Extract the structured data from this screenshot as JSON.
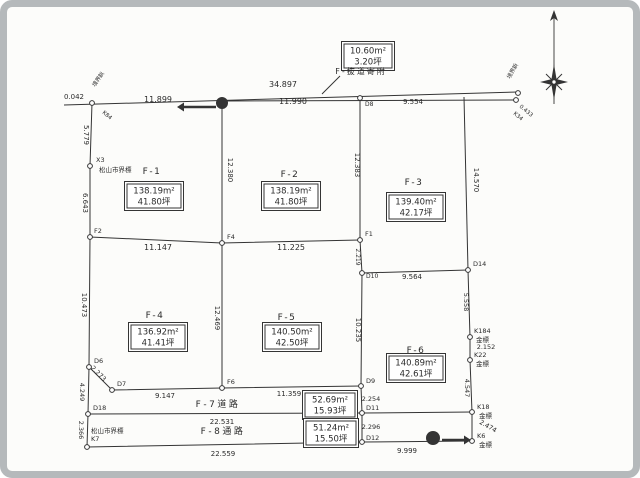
{
  "document": {
    "kind": "scanned land subdivision survey plan"
  },
  "palette": {
    "ink": "#343434",
    "paper": "#fcfcfa",
    "frame": "#b5b9bb",
    "box_bg": "#ffffff"
  },
  "annotation_box": {
    "area": "10.60m²",
    "tsubo": "3.20坪",
    "caption": "F-抜道寄附",
    "box_x": 368,
    "box_y": 56,
    "caption_x": 361,
    "caption_y": 74
  },
  "plots": [
    {
      "id": "F-1",
      "area": "138.19m²",
      "tsubo": "41.80坪",
      "label_x": 152,
      "label_y": 174,
      "box_x": 154,
      "box_y": 196
    },
    {
      "id": "F-2",
      "area": "138.19m²",
      "tsubo": "41.80坪",
      "label_x": 290,
      "label_y": 177,
      "box_x": 291,
      "box_y": 196
    },
    {
      "id": "F-3",
      "area": "139.40m²",
      "tsubo": "42.17坪",
      "label_x": 414,
      "label_y": 185,
      "box_x": 416,
      "box_y": 207
    },
    {
      "id": "F-4",
      "area": "136.92m²",
      "tsubo": "41.41坪",
      "label_x": 155,
      "label_y": 318,
      "box_x": 158,
      "box_y": 337
    },
    {
      "id": "F-5",
      "area": "140.50m²",
      "tsubo": "42.50坪",
      "label_x": 287,
      "label_y": 320,
      "box_x": 292,
      "box_y": 337
    },
    {
      "id": "F-6",
      "area": "140.89m²",
      "tsubo": "42.61坪",
      "label_x": 416,
      "label_y": 353,
      "box_x": 416,
      "box_y": 368
    }
  ],
  "roads": [
    {
      "id": "F-7道路",
      "area": "52.69m²",
      "tsubo": "15.93坪",
      "label_x": 218,
      "label_y": 407,
      "box_x": 330,
      "box_y": 405
    },
    {
      "id": "F-8通路",
      "area": "51.24m²",
      "tsubo": "15.50坪",
      "label_x": 223,
      "label_y": 434,
      "box_x": 331,
      "box_y": 433
    }
  ],
  "drawing": {
    "lines": [
      {
        "name": "top-road-line",
        "pts": [
          [
            64,
            105
          ],
          [
            518,
            92
          ]
        ]
      },
      {
        "name": "road-sliver-line",
        "pts": [
          [
            222,
            101
          ],
          [
            516,
            100
          ]
        ]
      },
      {
        "name": "left-boundary",
        "pts": [
          [
            92,
            103
          ],
          [
            90,
            166
          ],
          [
            90,
            237
          ],
          [
            89,
            367
          ],
          [
            88,
            414
          ],
          [
            87,
            447
          ]
        ]
      },
      {
        "name": "right-upper-boundary",
        "pts": [
          [
            464,
            97
          ],
          [
            468,
            270
          ]
        ]
      },
      {
        "name": "right-lower-boundary",
        "pts": [
          [
            468,
            270
          ],
          [
            470,
            337
          ],
          [
            470,
            360
          ],
          [
            472,
            412
          ],
          [
            472,
            441
          ]
        ]
      },
      {
        "name": "mid-horizontal-line",
        "pts": [
          [
            90,
            237
          ],
          [
            222,
            243
          ],
          [
            360,
            240
          ]
        ]
      },
      {
        "name": "f3-bottom-line",
        "pts": [
          [
            362,
            273
          ],
          [
            468,
            270
          ]
        ]
      },
      {
        "name": "divider-west",
        "pts": [
          [
            222,
            100
          ],
          [
            222,
            243
          ],
          [
            222,
            388
          ]
        ]
      },
      {
        "name": "divider-east",
        "pts": [
          [
            360,
            97
          ],
          [
            360,
            240
          ],
          [
            362,
            273
          ],
          [
            361,
            386
          ],
          [
            362,
            413
          ],
          [
            362,
            442
          ]
        ]
      },
      {
        "name": "road-top-line",
        "pts": [
          [
            112,
            390
          ],
          [
            222,
            388
          ],
          [
            361,
            386
          ]
        ]
      },
      {
        "name": "corner-diagonal",
        "pts": [
          [
            89,
            367
          ],
          [
            112,
            390
          ]
        ]
      },
      {
        "name": "road-mid-line",
        "pts": [
          [
            88,
            414
          ],
          [
            362,
            413
          ],
          [
            472,
            412
          ]
        ]
      },
      {
        "name": "bottom-line",
        "pts": [
          [
            87,
            447
          ],
          [
            362,
            442
          ],
          [
            472,
            441
          ]
        ]
      },
      {
        "name": "annotation-leader",
        "pts": [
          [
            340,
            76
          ],
          [
            322,
            94
          ]
        ]
      }
    ],
    "points": [
      [
        92,
        103
      ],
      [
        90,
        166
      ],
      [
        90,
        237
      ],
      [
        89,
        367
      ],
      [
        112,
        390
      ],
      [
        88,
        414
      ],
      [
        87,
        447
      ],
      [
        360,
        98
      ],
      [
        222,
        243
      ],
      [
        360,
        240
      ],
      [
        362,
        273
      ],
      [
        222,
        388
      ],
      [
        361,
        386
      ],
      [
        362,
        413
      ],
      [
        362,
        442
      ],
      [
        468,
        270
      ],
      [
        470,
        337
      ],
      [
        470,
        360
      ],
      [
        472,
        412
      ],
      [
        472,
        441
      ],
      [
        518,
        93
      ],
      [
        516,
        100
      ]
    ],
    "labels": [
      {
        "k": "measure",
        "t": "0.042",
        "x": 74,
        "y": 99,
        "s": 7
      },
      {
        "k": "measure",
        "t": "34.897",
        "x": 283,
        "y": 87,
        "s": 8
      },
      {
        "k": "measure",
        "t": "11.899",
        "x": 158,
        "y": 102,
        "s": 8
      },
      {
        "k": "measure",
        "t": "11.990",
        "x": 293,
        "y": 104,
        "s": 8
      },
      {
        "k": "measure",
        "t": "9.554",
        "x": 413,
        "y": 104,
        "s": 7
      },
      {
        "k": "measure",
        "t": "5.779",
        "x": 84,
        "y": 135,
        "s": 7,
        "r": 90
      },
      {
        "k": "measure",
        "t": "6.643",
        "x": 83,
        "y": 203,
        "s": 7,
        "r": 90
      },
      {
        "k": "measure",
        "t": "10.473",
        "x": 82,
        "y": 305,
        "s": 7,
        "r": 90
      },
      {
        "k": "measure",
        "t": "2.273",
        "x": 97,
        "y": 375,
        "s": 6.5,
        "r": 45
      },
      {
        "k": "measure",
        "t": "4.249",
        "x": 80,
        "y": 392,
        "s": 6.5,
        "r": 90
      },
      {
        "k": "measure",
        "t": "2.366",
        "x": 79,
        "y": 430,
        "s": 6.5,
        "r": 90
      },
      {
        "k": "measure",
        "t": "12.380",
        "x": 228,
        "y": 170,
        "s": 7,
        "r": 90
      },
      {
        "k": "measure",
        "t": "12.469",
        "x": 215,
        "y": 318,
        "s": 7,
        "r": 90
      },
      {
        "k": "measure",
        "t": "12.383",
        "x": 355,
        "y": 165,
        "s": 7,
        "r": 90
      },
      {
        "k": "measure",
        "t": "2.219",
        "x": 356,
        "y": 257,
        "s": 6,
        "r": 90
      },
      {
        "k": "measure",
        "t": "10.235",
        "x": 356,
        "y": 330,
        "s": 7,
        "r": 90
      },
      {
        "k": "measure",
        "t": "14.570",
        "x": 474,
        "y": 180,
        "s": 7,
        "r": 90
      },
      {
        "k": "measure",
        "t": "5.558",
        "x": 464,
        "y": 302,
        "s": 6.5,
        "r": 90
      },
      {
        "k": "measure",
        "t": "2.152",
        "x": 486,
        "y": 349,
        "s": 6.5
      },
      {
        "k": "measure",
        "t": "4.547",
        "x": 465,
        "y": 388,
        "s": 6.5,
        "r": 90
      },
      {
        "k": "measure",
        "t": "2.474",
        "x": 487,
        "y": 428,
        "s": 6.5,
        "r": 30
      },
      {
        "k": "measure",
        "t": "2.254",
        "x": 371,
        "y": 401,
        "s": 6.5
      },
      {
        "k": "measure",
        "t": "2.296",
        "x": 371,
        "y": 429,
        "s": 6.5
      },
      {
        "k": "measure",
        "t": "11.147",
        "x": 158,
        "y": 250,
        "s": 8
      },
      {
        "k": "measure",
        "t": "11.225",
        "x": 291,
        "y": 250,
        "s": 8
      },
      {
        "k": "measure",
        "t": "9.564",
        "x": 412,
        "y": 279,
        "s": 7
      },
      {
        "k": "measure",
        "t": "9.147",
        "x": 165,
        "y": 398,
        "s": 7
      },
      {
        "k": "measure",
        "t": "11.359",
        "x": 289,
        "y": 396,
        "s": 7
      },
      {
        "k": "measure",
        "t": "22.531",
        "x": 222,
        "y": 424,
        "s": 7
      },
      {
        "k": "measure",
        "t": "22.559",
        "x": 223,
        "y": 456,
        "s": 7
      },
      {
        "k": "measure",
        "t": "9.999",
        "x": 407,
        "y": 453,
        "s": 7
      },
      {
        "k": "point",
        "t": "X3",
        "x": 96,
        "y": 162,
        "s": 6.5,
        "a": "s"
      },
      {
        "k": "point",
        "t": "松山市界標",
        "x": 99,
        "y": 172,
        "s": 6.5,
        "a": "s"
      },
      {
        "k": "point",
        "t": "F2",
        "x": 94,
        "y": 233,
        "s": 6.5,
        "a": "s"
      },
      {
        "k": "point",
        "t": "D6",
        "x": 94,
        "y": 363,
        "s": 6.5,
        "a": "s"
      },
      {
        "k": "point",
        "t": "D7",
        "x": 117,
        "y": 386,
        "s": 6.5,
        "a": "s"
      },
      {
        "k": "point",
        "t": "D18",
        "x": 93,
        "y": 410,
        "s": 6.5,
        "a": "s"
      },
      {
        "k": "point",
        "t": "松山市界標",
        "x": 91,
        "y": 433,
        "s": 6.5,
        "a": "s"
      },
      {
        "k": "point",
        "t": "K7",
        "x": 91,
        "y": 441,
        "s": 6.5,
        "a": "s"
      },
      {
        "k": "point",
        "t": "D8",
        "x": 365,
        "y": 106,
        "s": 6,
        "a": "s"
      },
      {
        "k": "point",
        "t": "F4",
        "x": 227,
        "y": 239,
        "s": 6.5,
        "a": "s"
      },
      {
        "k": "point",
        "t": "F1",
        "x": 365,
        "y": 236,
        "s": 6.5,
        "a": "s"
      },
      {
        "k": "point",
        "t": "D10",
        "x": 366,
        "y": 278,
        "s": 6,
        "a": "s"
      },
      {
        "k": "point",
        "t": "F6",
        "x": 227,
        "y": 384,
        "s": 6.5,
        "a": "s"
      },
      {
        "k": "point",
        "t": "D9",
        "x": 366,
        "y": 383,
        "s": 6.5,
        "a": "s"
      },
      {
        "k": "point",
        "t": "D11",
        "x": 366,
        "y": 410,
        "s": 6.5,
        "a": "s"
      },
      {
        "k": "point",
        "t": "D12",
        "x": 366,
        "y": 440,
        "s": 6.5,
        "a": "s"
      },
      {
        "k": "point",
        "t": "D14",
        "x": 473,
        "y": 266,
        "s": 6.5,
        "a": "s"
      },
      {
        "k": "point",
        "t": "K184",
        "x": 474,
        "y": 333,
        "s": 6.5,
        "a": "s"
      },
      {
        "k": "point",
        "t": "金標",
        "x": 476,
        "y": 342,
        "s": 6.5,
        "a": "s"
      },
      {
        "k": "point",
        "t": "K22",
        "x": 474,
        "y": 357,
        "s": 6.5,
        "a": "s"
      },
      {
        "k": "point",
        "t": "金標",
        "x": 476,
        "y": 366,
        "s": 6.5,
        "a": "s"
      },
      {
        "k": "point",
        "t": "K18",
        "x": 477,
        "y": 409,
        "s": 6.5,
        "a": "s"
      },
      {
        "k": "point",
        "t": "金標",
        "x": 479,
        "y": 418,
        "s": 6.5,
        "a": "s"
      },
      {
        "k": "point",
        "t": "K6",
        "x": 477,
        "y": 438,
        "s": 6.5,
        "a": "s"
      },
      {
        "k": "point",
        "t": "金標",
        "x": 479,
        "y": 447,
        "s": 6.5,
        "a": "s"
      },
      {
        "k": "micro",
        "t": "境界鋲",
        "x": 95,
        "y": 87,
        "s": 5.5,
        "r": -55,
        "a": "s"
      },
      {
        "k": "micro",
        "t": "K84",
        "x": 102,
        "y": 113,
        "s": 5.5,
        "r": 40,
        "a": "s"
      },
      {
        "k": "micro",
        "t": "境界鋲",
        "x": 510,
        "y": 79,
        "s": 5.5,
        "r": -60,
        "a": "s"
      },
      {
        "k": "micro",
        "t": "0.433",
        "x": 519,
        "y": 107,
        "s": 5.5,
        "r": 40,
        "a": "s"
      },
      {
        "k": "micro",
        "t": "K34",
        "x": 513,
        "y": 114,
        "s": 5.5,
        "r": 40,
        "a": "s"
      }
    ],
    "pole_markers": [
      {
        "x": 222,
        "y": 103,
        "r": 6,
        "arrow": [
          216,
          107,
          184,
          107
        ],
        "dir": "left"
      },
      {
        "x": 433,
        "y": 438,
        "r": 7,
        "arrow": [
          442,
          440,
          464,
          440
        ],
        "dir": "right"
      }
    ],
    "compass": {
      "x": 554,
      "top": 10,
      "bottom": 104,
      "star_y": 82
    }
  }
}
